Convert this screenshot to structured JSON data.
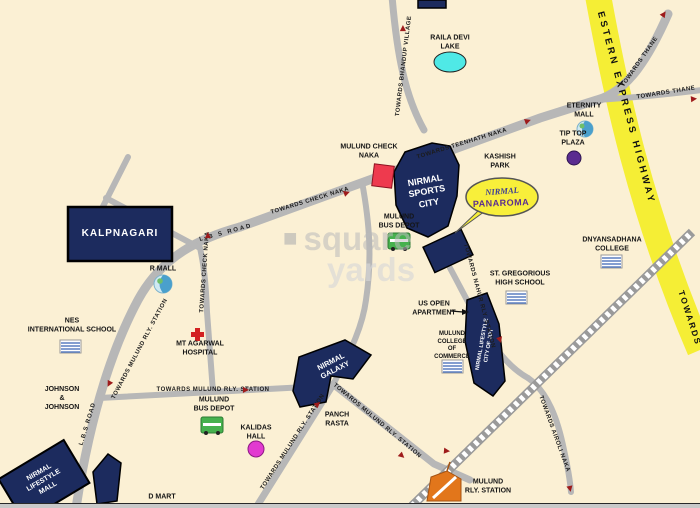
{
  "title": "Mulund locality map - Nirmal Panaroma",
  "colors": {
    "background": "#fbf0d4",
    "road_gray": "#b7b7b7",
    "railway_gray": "#9a9a9a",
    "highway_yellow": "#f5ee35",
    "building_navy": "#1c2b5e",
    "check_naka_red": "#ee3a4e",
    "lake_cyan": "#4fe9e6",
    "callout_yellow": "#f8ef3a",
    "arrow_red": "#9e1b1b",
    "bus_green": "#46b14e",
    "station_orange": "#e2761b",
    "tip_top_purple": "#5a2c90",
    "kalidas_magenta": "#e23ad0"
  },
  "watermark": {
    "word1": "square",
    "word2": "yards"
  },
  "map": {
    "labels": [
      {
        "n": "raila-devi-lake-label",
        "t": "RAILA DEVI\nLAKE",
        "x": 450,
        "y": 43,
        "c": "lbl"
      },
      {
        "n": "eternity-mall-label",
        "t": "ETERNITY\nMALL",
        "x": 584,
        "y": 111,
        "c": "lbl"
      },
      {
        "n": "tip-top-plaza-label",
        "t": "TIP TOP\nPLAZA",
        "x": 573,
        "y": 139,
        "c": "lbl"
      },
      {
        "n": "kashish-park-label",
        "t": "KASHISH\nPARK",
        "x": 500,
        "y": 162,
        "c": "lbl"
      },
      {
        "n": "mulund-check-naka-label",
        "t": "MULUND CHECK\nNAKA",
        "x": 369,
        "y": 152,
        "c": "lbl"
      },
      {
        "n": "mulund-bus-depot-north-label",
        "t": "MULUND\nBUS DEPOT",
        "x": 399,
        "y": 222,
        "c": "lbl"
      },
      {
        "n": "r-mall-label",
        "t": "R MALL",
        "x": 163,
        "y": 270,
        "c": "lbl"
      },
      {
        "n": "dnyansadhana-college-label",
        "t": "DNYANSADHANA\nCOLLEGE",
        "x": 612,
        "y": 245,
        "c": "lbl"
      },
      {
        "n": "st-gregorious-high-school-label",
        "t": "ST. GREGORIOUS\nHIGH SCHOOL",
        "x": 520,
        "y": 279,
        "c": "lbl"
      },
      {
        "n": "us-open-apartment-label",
        "t": "US OPEN\nAPARTMENT",
        "x": 434,
        "y": 309,
        "c": "lbl"
      },
      {
        "n": "mulund-college-of-commerce-label",
        "t": "MULUND\nCOLLEGE\nOF\nCOMMERCE",
        "x": 452,
        "y": 346,
        "c": "lbl-sm"
      },
      {
        "n": "nes-international-school-label",
        "t": "NES\nINTERNATIONAL SCHOOL",
        "x": 72,
        "y": 326,
        "c": "lbl"
      },
      {
        "n": "mt-agarwal-hospital-label",
        "t": "MT AGARWAL\nHOSPITAL",
        "x": 200,
        "y": 349,
        "c": "lbl"
      },
      {
        "n": "johnson-johnson-label",
        "t": "JOHNSON\n&\nJOHNSON",
        "x": 62,
        "y": 399,
        "c": "lbl"
      },
      {
        "n": "mulund-bus-depot-south-label",
        "t": "MULUND\nBUS DEPOT",
        "x": 214,
        "y": 405,
        "c": "lbl"
      },
      {
        "n": "kalidas-hall-label",
        "t": "KALIDAS\nHALL",
        "x": 256,
        "y": 433,
        "c": "lbl"
      },
      {
        "n": "panch-rasta-label",
        "t": "PANCH\nRASTA",
        "x": 337,
        "y": 420,
        "c": "lbl"
      },
      {
        "n": "d-mart-label",
        "t": "D MART",
        "x": 162,
        "y": 498,
        "c": "lbl"
      },
      {
        "n": "mulund-rly-station-label",
        "t": "MULUND\nRLY. STATION",
        "x": 488,
        "y": 487,
        "c": "lbl"
      },
      {
        "n": "kalpnagari-label",
        "t": "KALPNAGARI",
        "x": 120,
        "y": 234,
        "c": "bld",
        "s": 10,
        "ls": 1
      },
      {
        "n": "nirmal-sports-city-label",
        "t": "NIRMAL\nSPORTS\nCITY",
        "x": 427,
        "y": 192,
        "r": -10,
        "c": "bld",
        "s": 9
      },
      {
        "n": "nirmal-galaxy-label",
        "t": "NIRMAL\nGALAXY",
        "x": 333,
        "y": 366,
        "r": -27,
        "c": "bld",
        "s": 7.5
      },
      {
        "n": "nirmal-lifestyle-mall-label",
        "t": "NIRMAL\nLIFESTYLE\nMALL",
        "x": 44,
        "y": 481,
        "r": -30,
        "c": "bld",
        "s": 7
      },
      {
        "n": "city-of-joy-label",
        "t": "NIRMAL LIFESTYLE\nCITY OF JOY",
        "x": 486,
        "y": 345,
        "r": -80,
        "c": "bld",
        "s": 5.5
      },
      {
        "n": "nirmal-panaroma-name",
        "t": "NIRMAL",
        "x": 502,
        "y": 191,
        "r": -4,
        "c": "callout-script"
      },
      {
        "n": "nirmal-panaroma-sub",
        "t": "PANAROMA",
        "x": 501,
        "y": 203,
        "r": -2,
        "c": "callout-bold"
      },
      {
        "n": "road-label-towards-bhandup-village",
        "t": "TOWARDS BHANDUP VILLAGE",
        "x": 404,
        "y": 66,
        "r": -83,
        "c": "road"
      },
      {
        "n": "road-label-lbs-road-upper",
        "t": "L B S ROAD",
        "x": 226,
        "y": 233,
        "r": -15,
        "c": "road",
        "ls": 2
      },
      {
        "n": "road-label-towards-check-naka",
        "t": "TOWARDS CHECK NAKA",
        "x": 310,
        "y": 201,
        "r": -17,
        "c": "road"
      },
      {
        "n": "road-label-towards-teenhath-naka",
        "t": "TOWARDS TEENHATH NAKA",
        "x": 462,
        "y": 144,
        "r": -17,
        "c": "road"
      },
      {
        "n": "road-label-towards-thane-north",
        "t": "TOWARDS THANE",
        "x": 640,
        "y": 62,
        "r": -55,
        "c": "road"
      },
      {
        "n": "road-label-towards-thane-east",
        "t": "TOWARDS THANE",
        "x": 666,
        "y": 93,
        "r": -9,
        "c": "road"
      },
      {
        "n": "road-label-towards-check-naka-vertical",
        "t": "TOWARDS CHECK NAKA",
        "x": 205,
        "y": 272,
        "r": -86,
        "c": "road"
      },
      {
        "n": "road-label-towards-mulund-rly-station-lbs",
        "t": "TOWARDS MULUND RLY. STATION",
        "x": 140,
        "y": 349,
        "r": -62,
        "c": "road"
      },
      {
        "n": "road-label-lbs-road-lower",
        "t": "L.B.S ROAD",
        "x": 88,
        "y": 424,
        "r": -73,
        "c": "road",
        "ls": 1
      },
      {
        "n": "road-label-towards-mulund-rly-station-mid",
        "t": "TOWARDS MULUND RLY. STATION",
        "x": 213,
        "y": 390,
        "c": "road"
      },
      {
        "n": "road-label-towards-mulund-rly-station-sw",
        "t": "TOWARDS MULUND RLY. STATION",
        "x": 293,
        "y": 442,
        "r": -57,
        "c": "road"
      },
      {
        "n": "road-label-towards-mulund-rly-station-se",
        "t": "TOWARDS MULUND RLY. STATION",
        "x": 377,
        "y": 421,
        "r": 40,
        "c": "road"
      },
      {
        "n": "road-label-towards-nahur-rly-station",
        "t": "TOWARDS NAHUR RLY. STATION",
        "x": 479,
        "y": 296,
        "r": 75,
        "c": "road"
      },
      {
        "n": "road-label-towards-airoli-naka",
        "t": "TOWARDS AIROLI NAKA",
        "x": 554,
        "y": 434,
        "r": 70,
        "c": "road"
      },
      {
        "n": "highway-label",
        "t": "ESTERN  EXPRESS  HIGHWAY",
        "x": 626,
        "y": 108,
        "r": 75,
        "c": "hwy"
      },
      {
        "n": "highway-towards-label",
        "t": "TOWARDS",
        "x": 690,
        "y": 318,
        "r": 72,
        "c": "hwy2"
      }
    ],
    "arrows": [
      {
        "x": 403,
        "y": 28,
        "r": -90
      },
      {
        "x": 528,
        "y": 121,
        "r": -20
      },
      {
        "x": 664,
        "y": 14,
        "r": -55
      },
      {
        "x": 694,
        "y": 99,
        "r": -5
      },
      {
        "x": 208,
        "y": 235,
        "r": -90
      },
      {
        "x": 347,
        "y": 193,
        "r": -20
      },
      {
        "x": 109,
        "y": 384,
        "r": 118
      },
      {
        "x": 246,
        "y": 390,
        "r": 0
      },
      {
        "x": 318,
        "y": 404,
        "r": -40
      },
      {
        "x": 402,
        "y": 456,
        "r": 42
      },
      {
        "x": 447,
        "y": 451,
        "r": 5
      },
      {
        "x": 570,
        "y": 489,
        "r": 78
      },
      {
        "x": 500,
        "y": 340,
        "r": 72
      }
    ],
    "icons": [
      {
        "name": "raila-devi-lake",
        "type": "lake",
        "color": "#4fe9e6"
      },
      {
        "name": "eternity-mall-logo",
        "type": "swirl-circle",
        "color": "#4aa0cc"
      },
      {
        "name": "r-mall-logo",
        "type": "swirl-circle",
        "color": "#4aa0cc"
      },
      {
        "name": "tip-top-plaza-dot",
        "type": "circle",
        "color": "#5a2c90"
      },
      {
        "name": "kalidas-hall-dot",
        "type": "circle",
        "color": "#e23ad0"
      },
      {
        "name": "mulund-check-naka-marker",
        "type": "red-square",
        "color": "#ee3a4e"
      },
      {
        "name": "bus-depot-north",
        "type": "bus",
        "color": "#46b14e"
      },
      {
        "name": "bus-depot-south",
        "type": "bus",
        "color": "#46b14e"
      },
      {
        "name": "mt-agarwal-hospital-cross",
        "type": "red-cross",
        "color": "#d22"
      },
      {
        "name": "school-college-building",
        "type": "striped-rect",
        "color": "#5b7fc0"
      },
      {
        "name": "mulund-rly-station-marker",
        "type": "station",
        "color": "#e2761b"
      }
    ]
  }
}
